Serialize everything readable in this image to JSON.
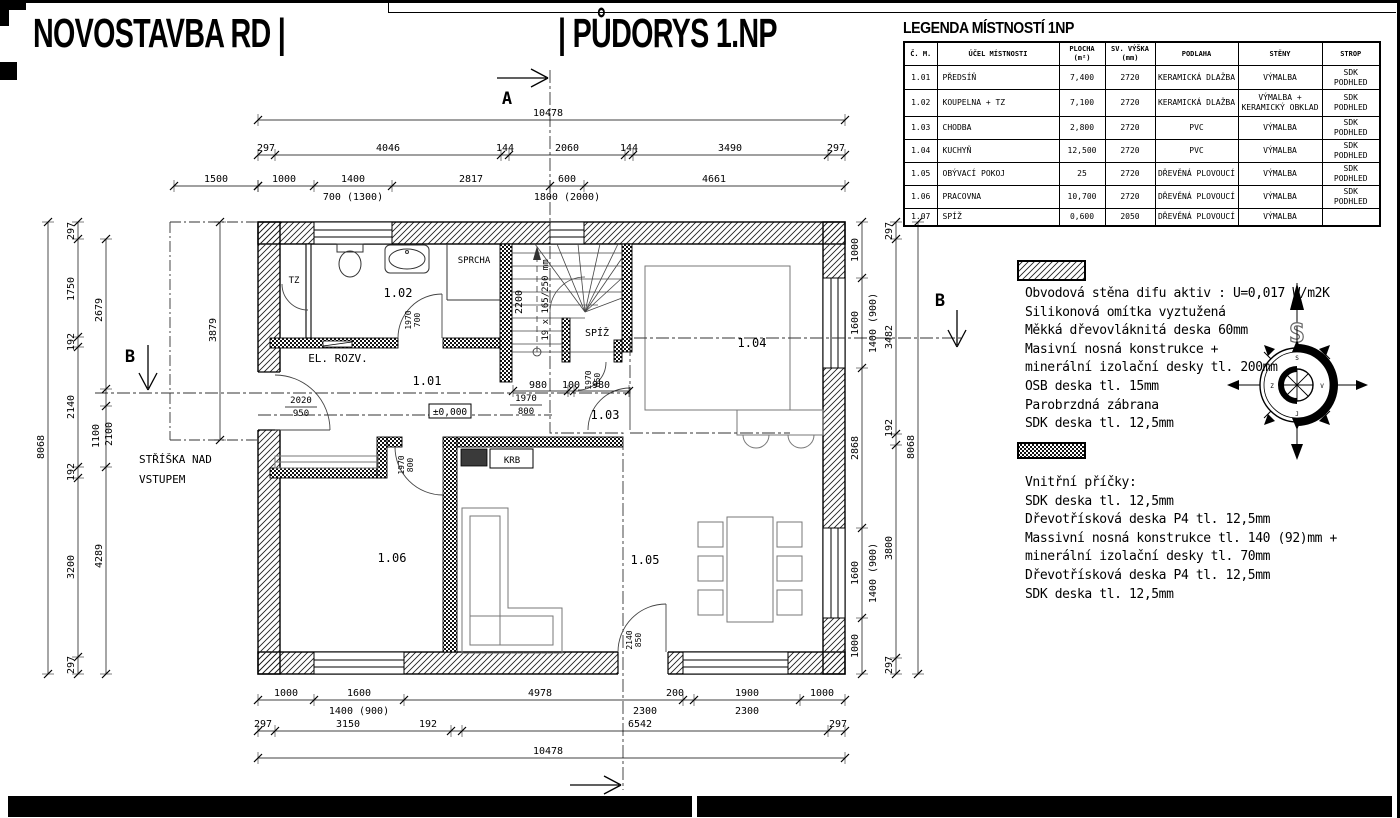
{
  "titles": {
    "left": "NOVOSTAVBA RD |",
    "right": "| PŮDORYS 1.NP"
  },
  "legend": {
    "title": "LEGENDA MÍSTNOSTÍ 1NP",
    "columns": [
      "Č. M.",
      "ÚČEL MÍSTNOSTI",
      "PLOCHA (m²)",
      "SV. VÝŠKA (mm)",
      "PODLAHA",
      "STĚNY",
      "STROP"
    ],
    "rows": [
      [
        "1.01",
        "PŘEDSÍŇ",
        "7,400",
        "2720",
        "KERAMICKÁ DLAŽBA",
        "VÝMALBA",
        "SDK PODHLED"
      ],
      [
        "1.02",
        "KOUPELNA + TZ",
        "7,100",
        "2720",
        "KERAMICKÁ DLAŽBA",
        "VÝMALBA + KERAMICKÝ OBKLAD",
        "SDK PODHLED"
      ],
      [
        "1.03",
        "CHODBA",
        "2,800",
        "2720",
        "PVC",
        "VÝMALBA",
        "SDK PODHLED"
      ],
      [
        "1.04",
        "KUCHYŇ",
        "12,500",
        "2720",
        "PVC",
        "VÝMALBA",
        "SDK PODHLED"
      ],
      [
        "1.05",
        "OBÝVACÍ POKOJ",
        "25",
        "2720",
        "DŘEVĚNÁ PLOVOUCÍ",
        "VÝMALBA",
        "SDK PODHLED"
      ],
      [
        "1.06",
        "PRACOVNA",
        "10,700",
        "2720",
        "DŘEVĚNÁ PLOVOUCÍ",
        "VÝMALBA",
        "SDK PODHLED"
      ],
      [
        "1.07",
        "SPÍŽ",
        "0,600",
        "2050",
        "DŘEVĚNÁ PLOVOUCÍ",
        "VÝMALBA",
        ""
      ]
    ],
    "row_heights": [
      24,
      27,
      16,
      16,
      16,
      17,
      17
    ]
  },
  "notes_exterior": {
    "lines": [
      "Obvodová stěna difu aktiv : U=0,017 W/m2K",
      "Silikonová omítka vyztužená",
      "Měkká dřevovláknitá deska 60mm",
      "Masivní nosná konstrukce +",
      "minerální izolační desky tl. 200mm",
      "OSB deska tl. 15mm",
      "Parobrzdná zábrana",
      "SDK deska tl. 12,5mm"
    ]
  },
  "notes_interior": {
    "lines": [
      "Vnitřní příčky:",
      "SDK deska tl. 12,5mm",
      "Dřevotřísková deska P4 tl. 12,5mm",
      "Massivní nosná konstrukce tl. 140 (92)mm +",
      "minerální izolační desky tl. 70mm",
      "Dřevotřísková deska P4 tl. 12,5mm",
      "SDK deska tl. 12,5mm"
    ]
  },
  "compass": {
    "north": "S",
    "points": [
      "S",
      "V",
      "J",
      "Z"
    ]
  },
  "plan_labels": [
    {
      "t": "1.01",
      "x": 427,
      "y": 385,
      "s": 12
    },
    {
      "t": "1.02",
      "x": 398,
      "y": 297,
      "s": 12
    },
    {
      "t": "1.03",
      "x": 605,
      "y": 419,
      "s": 12
    },
    {
      "t": "1.04",
      "x": 752,
      "y": 347,
      "s": 12
    },
    {
      "t": "1.05",
      "x": 645,
      "y": 564,
      "s": 12
    },
    {
      "t": "1.06",
      "x": 392,
      "y": 562,
      "s": 12
    },
    {
      "t": "TZ",
      "x": 294,
      "y": 283,
      "s": 9
    },
    {
      "t": "SPRCHA",
      "x": 474,
      "y": 263,
      "s": 9
    },
    {
      "t": "EL. ROZV.",
      "x": 338,
      "y": 362,
      "s": 11
    },
    {
      "t": "SPÍŽ",
      "x": 597,
      "y": 336,
      "s": 10
    },
    {
      "t": "KRB",
      "x": 512,
      "y": 463,
      "s": 9
    },
    {
      "t": "STŘÍŠKA NAD",
      "x": 139,
      "y": 463,
      "s": 11,
      "a": "start"
    },
    {
      "t": "VSTUPEM",
      "x": 139,
      "y": 483,
      "s": 11,
      "a": "start"
    },
    {
      "t": "A",
      "x": 507,
      "y": 104,
      "s": 17,
      "b": 1
    },
    {
      "t": "A",
      "x": 584,
      "y": 811,
      "s": 17,
      "b": 1
    },
    {
      "t": "B",
      "x": 130,
      "y": 362,
      "s": 17,
      "b": 1
    },
    {
      "t": "B",
      "x": 940,
      "y": 306,
      "s": 17,
      "b": 1
    }
  ],
  "rot_labels": [
    {
      "t": "1970",
      "x": 411,
      "y": 320
    },
    {
      "t": "700",
      "x": 420,
      "y": 320
    },
    {
      "t": "1970",
      "x": 404,
      "y": 465
    },
    {
      "t": "800",
      "x": 413,
      "y": 465
    },
    {
      "t": "1970",
      "x": 591,
      "y": 380
    },
    {
      "t": "650",
      "x": 600,
      "y": 380
    },
    {
      "t": "2140",
      "x": 632,
      "y": 640
    },
    {
      "t": "850",
      "x": 641,
      "y": 640
    },
    {
      "t": "2200",
      "x": 522,
      "y": 302,
      "s": 10
    },
    {
      "t": "19 x 165/250 mm",
      "x": 548,
      "y": 300,
      "s": 9
    }
  ],
  "frac_labels": [
    {
      "top": "2020",
      "bot": "950",
      "x": 301,
      "y": 403
    },
    {
      "top": "1970",
      "bot": "800",
      "x": 526,
      "y": 401
    }
  ],
  "boxed_labels": [
    {
      "t": "±0,000",
      "x": 450,
      "y": 414
    }
  ],
  "dims_h": [
    {
      "y": 120,
      "x1": 258,
      "x2": 845,
      "ticks": [
        258,
        845
      ],
      "labels": [
        {
          "t": "10478",
          "x": 548,
          "y": 116
        }
      ]
    },
    {
      "y": 155,
      "x1": 258,
      "x2": 845,
      "ticks": [
        258,
        275,
        501,
        509,
        625,
        633,
        828,
        845
      ],
      "labels": [
        {
          "t": "297",
          "x": 266,
          "y": 151
        },
        {
          "t": "4046",
          "x": 388,
          "y": 151
        },
        {
          "t": "144",
          "x": 505,
          "y": 151
        },
        {
          "t": "2060",
          "x": 567,
          "y": 151
        },
        {
          "t": "144",
          "x": 629,
          "y": 151
        },
        {
          "t": "3490",
          "x": 730,
          "y": 151
        },
        {
          "t": "297",
          "x": 836,
          "y": 151
        }
      ]
    },
    {
      "y": 186,
      "x1": 258,
      "x2": 845,
      "ticks": [
        258,
        314,
        392,
        550,
        584,
        845
      ],
      "labels": [
        {
          "t": "1000",
          "x": 284,
          "y": 182
        },
        {
          "t": "1400",
          "x": 353,
          "y": 182
        },
        {
          "t": "700 (1300)",
          "x": 353,
          "y": 200
        },
        {
          "t": "2817",
          "x": 471,
          "y": 182
        },
        {
          "t": "600",
          "x": 567,
          "y": 182
        },
        {
          "t": "1800 (2000)",
          "x": 567,
          "y": 200
        },
        {
          "t": "4661",
          "x": 714,
          "y": 182
        }
      ]
    },
    {
      "y": 186,
      "x1": 174,
      "x2": 258,
      "ticks": [
        174,
        258
      ],
      "labels": [
        {
          "t": "1500",
          "x": 216,
          "y": 182
        }
      ]
    },
    {
      "y": 700,
      "x1": 258,
      "x2": 845,
      "ticks": [
        258,
        314,
        404,
        683,
        694,
        800,
        845
      ],
      "labels": [
        {
          "t": "1000",
          "x": 286,
          "y": 696
        },
        {
          "t": "1600",
          "x": 359,
          "y": 696
        },
        {
          "t": "1400 (900)",
          "x": 359,
          "y": 714
        },
        {
          "t": "4978",
          "x": 540,
          "y": 696
        },
        {
          "t": "200",
          "x": 675,
          "y": 696
        },
        {
          "t": "2300",
          "x": 645,
          "y": 714
        },
        {
          "t": "1900",
          "x": 747,
          "y": 696
        },
        {
          "t": "2300",
          "x": 747,
          "y": 714
        },
        {
          "t": "1000",
          "x": 822,
          "y": 696
        }
      ]
    },
    {
      "y": 731,
      "x1": 258,
      "x2": 845,
      "ticks": [
        258,
        275,
        451,
        462,
        828,
        845
      ],
      "labels": [
        {
          "t": "297",
          "x": 263,
          "y": 727
        },
        {
          "t": "3150",
          "x": 348,
          "y": 727
        },
        {
          "t": "192",
          "x": 428,
          "y": 727
        },
        {
          "t": "6542",
          "x": 640,
          "y": 727
        },
        {
          "t": "297",
          "x": 838,
          "y": 727
        }
      ]
    },
    {
      "y": 758,
      "x1": 258,
      "x2": 845,
      "ticks": [
        258,
        845
      ],
      "labels": [
        {
          "t": "10478",
          "x": 548,
          "y": 754
        }
      ]
    },
    {
      "y": 391,
      "x1": 513,
      "x2": 629,
      "ticks": [
        513,
        568,
        574,
        629
      ],
      "labels": [
        {
          "t": "980",
          "x": 538,
          "y": 388
        },
        {
          "t": "100",
          "x": 571,
          "y": 388
        },
        {
          "t": "980",
          "x": 601,
          "y": 388
        }
      ]
    }
  ],
  "dims_v": [
    {
      "x": 48,
      "y1": 222,
      "y2": 674,
      "ticks": [
        222,
        674
      ],
      "labels": [
        {
          "t": "8068",
          "x": 44,
          "y": 447
        }
      ]
    },
    {
      "x": 78,
      "y1": 222,
      "y2": 674,
      "ticks": [
        222,
        239,
        337,
        347,
        467,
        478,
        657,
        674
      ],
      "labels": [
        {
          "t": "297",
          "x": 74,
          "y": 231
        },
        {
          "t": "1750",
          "x": 74,
          "y": 289
        },
        {
          "t": "192",
          "x": 74,
          "y": 342
        },
        {
          "t": "2140",
          "x": 74,
          "y": 407
        },
        {
          "t": "192",
          "x": 74,
          "y": 472
        },
        {
          "t": "3200",
          "x": 74,
          "y": 567
        },
        {
          "t": "297",
          "x": 74,
          "y": 665
        }
      ]
    },
    {
      "x": 106,
      "y1": 239,
      "y2": 674,
      "ticks": [
        239,
        389,
        406,
        467,
        674
      ],
      "labels": [
        {
          "t": "2679",
          "x": 102,
          "y": 310
        },
        {
          "t": "1100",
          "x": 99,
          "y": 436
        },
        {
          "t": "2100",
          "x": 112,
          "y": 434
        },
        {
          "t": "4289",
          "x": 102,
          "y": 556
        }
      ]
    },
    {
      "x": 220,
      "y1": 222,
      "y2": 440,
      "ticks": [
        222,
        440
      ],
      "labels": [
        {
          "t": "3879",
          "x": 216,
          "y": 330
        }
      ]
    },
    {
      "x": 862,
      "y1": 222,
      "y2": 674,
      "ticks": [
        222,
        278,
        368,
        528,
        618,
        674
      ],
      "labels": [
        {
          "t": "1000",
          "x": 858,
          "y": 250
        },
        {
          "t": "1600",
          "x": 858,
          "y": 323
        },
        {
          "t": "1400 (900)",
          "x": 876,
          "y": 323
        },
        {
          "t": "2868",
          "x": 858,
          "y": 448
        },
        {
          "t": "1600",
          "x": 858,
          "y": 573
        },
        {
          "t": "1400 (900)",
          "x": 876,
          "y": 573
        },
        {
          "t": "1000",
          "x": 858,
          "y": 646
        }
      ]
    },
    {
      "x": 896,
      "y1": 222,
      "y2": 674,
      "ticks": [
        222,
        239,
        434,
        445,
        658,
        674
      ],
      "labels": [
        {
          "t": "297",
          "x": 892,
          "y": 231
        },
        {
          "t": "3482",
          "x": 892,
          "y": 337
        },
        {
          "t": "192",
          "x": 892,
          "y": 428
        },
        {
          "t": "3800",
          "x": 892,
          "y": 548
        },
        {
          "t": "297",
          "x": 892,
          "y": 665
        }
      ]
    },
    {
      "x": 918,
      "y1": 222,
      "y2": 674,
      "ticks": [
        222,
        674
      ],
      "labels": [
        {
          "t": "8068",
          "x": 914,
          "y": 447
        }
      ]
    }
  ]
}
